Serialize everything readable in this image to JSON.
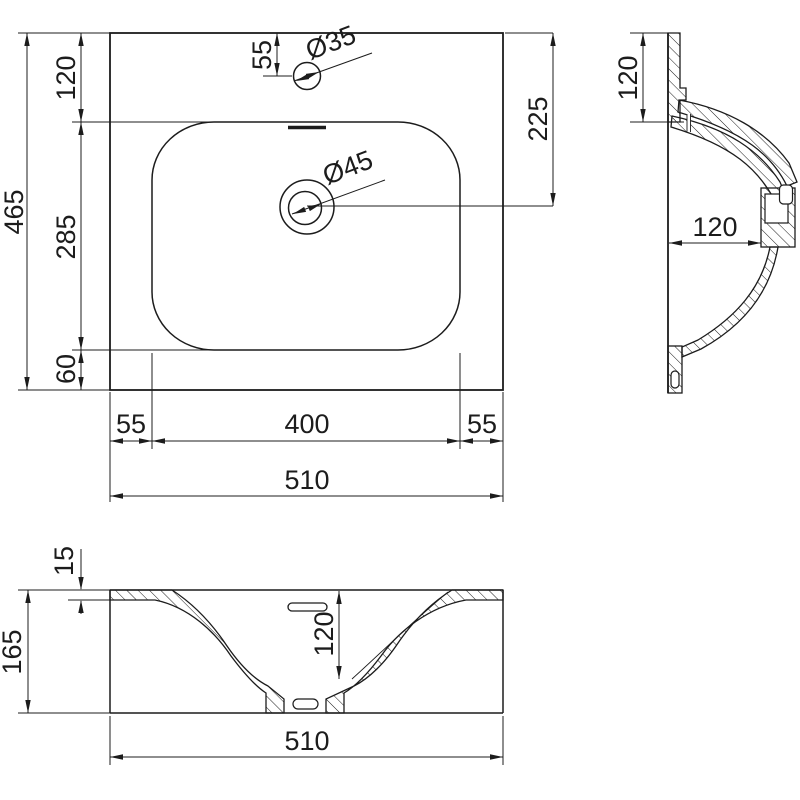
{
  "colors": {
    "ink": "#1c1c1c",
    "paper": "#ffffff"
  },
  "views": {
    "plan": {
      "dims": {
        "overall_depth": "465",
        "edge_to_basin": "120",
        "basin_depth": "285",
        "back_margin": "60",
        "faucet_offset": "55",
        "faucet_hole": "Ø35",
        "drain_hole": "Ø45",
        "drain_offset": "225",
        "left_margin": "55",
        "basin_width": "400",
        "right_margin": "55",
        "overall_width": "510"
      }
    },
    "side": {
      "dims": {
        "rim_to_basin": "120",
        "bowl_height": "120"
      }
    },
    "front": {
      "dims": {
        "deck_thickness": "15",
        "overall_height": "165",
        "bowl_depth": "120",
        "overall_width": "510"
      }
    }
  }
}
